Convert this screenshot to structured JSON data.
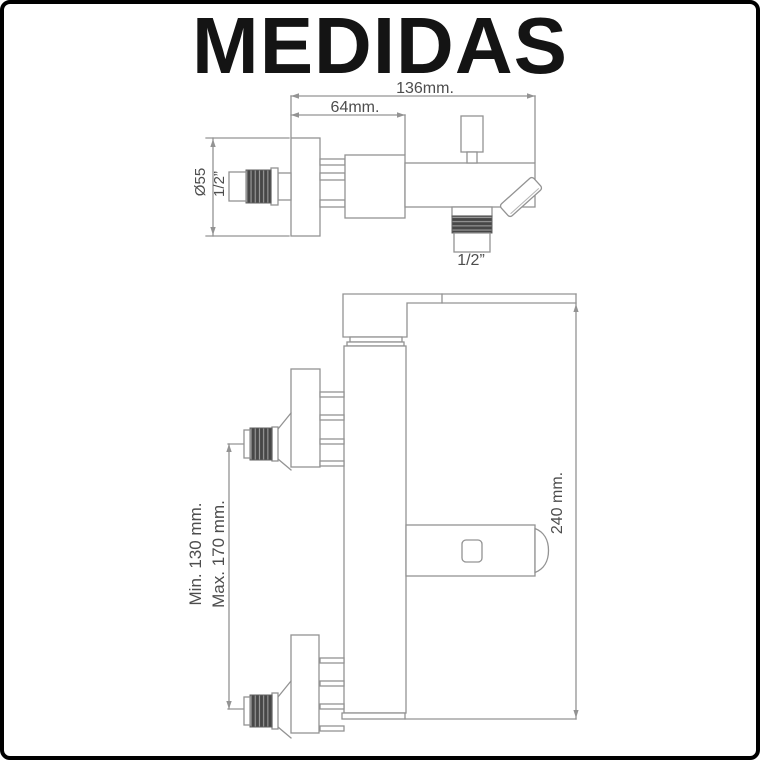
{
  "title": "MEDIDAS",
  "colors": {
    "line": "#939393",
    "thread-dark": "#474747",
    "thread-light": "#9c9c9c",
    "label": "#4d4d4d",
    "title": "#141414",
    "frame": "#000000",
    "background": "#ffffff"
  },
  "top_view": {
    "labels": {
      "total_width": "136mm.",
      "body_width": "64mm.",
      "flange_diameter": "Ø55",
      "inlet_thread": "1/2”",
      "outlet_thread": "1/2”"
    }
  },
  "side_view": {
    "labels": {
      "inlet_spacing_min": "Min. 130 mm.",
      "inlet_spacing_max": "Max. 170 mm.",
      "total_height": "240 mm."
    }
  }
}
